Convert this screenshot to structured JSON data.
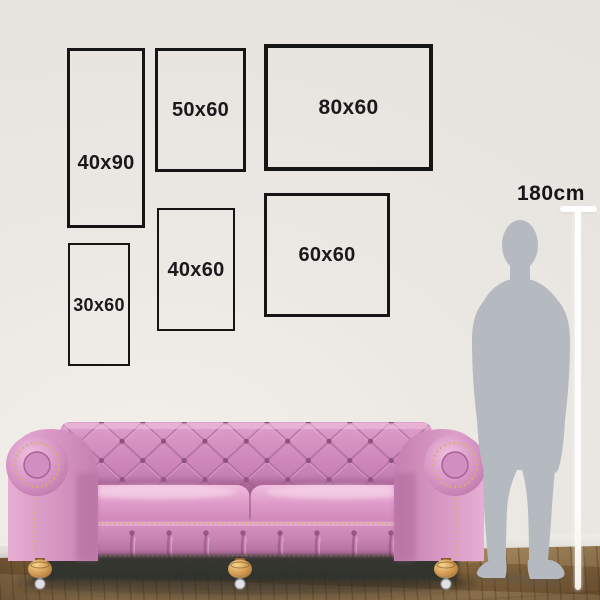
{
  "frames": [
    {
      "id": "40x90",
      "label": "40x90"
    },
    {
      "id": "50x60",
      "label": "50x60"
    },
    {
      "id": "80x60",
      "label": "80x60"
    },
    {
      "id": "30x60",
      "label": "30x60"
    },
    {
      "id": "40x60",
      "label": "40x60"
    },
    {
      "id": "60x60",
      "label": "60x60"
    }
  ],
  "height_marker": {
    "label": "180cm"
  },
  "colors": {
    "wall": "#e9e5e1",
    "frame_border": "#151515",
    "label_text": "#1a1a1a",
    "sofa_pink": "#d08cbb",
    "sofa_gold_trim": "#d9ae66",
    "silhouette_gray": "#b5b9c0",
    "floor_wood": "#8a6c42",
    "marker_line": "#ffffff"
  }
}
